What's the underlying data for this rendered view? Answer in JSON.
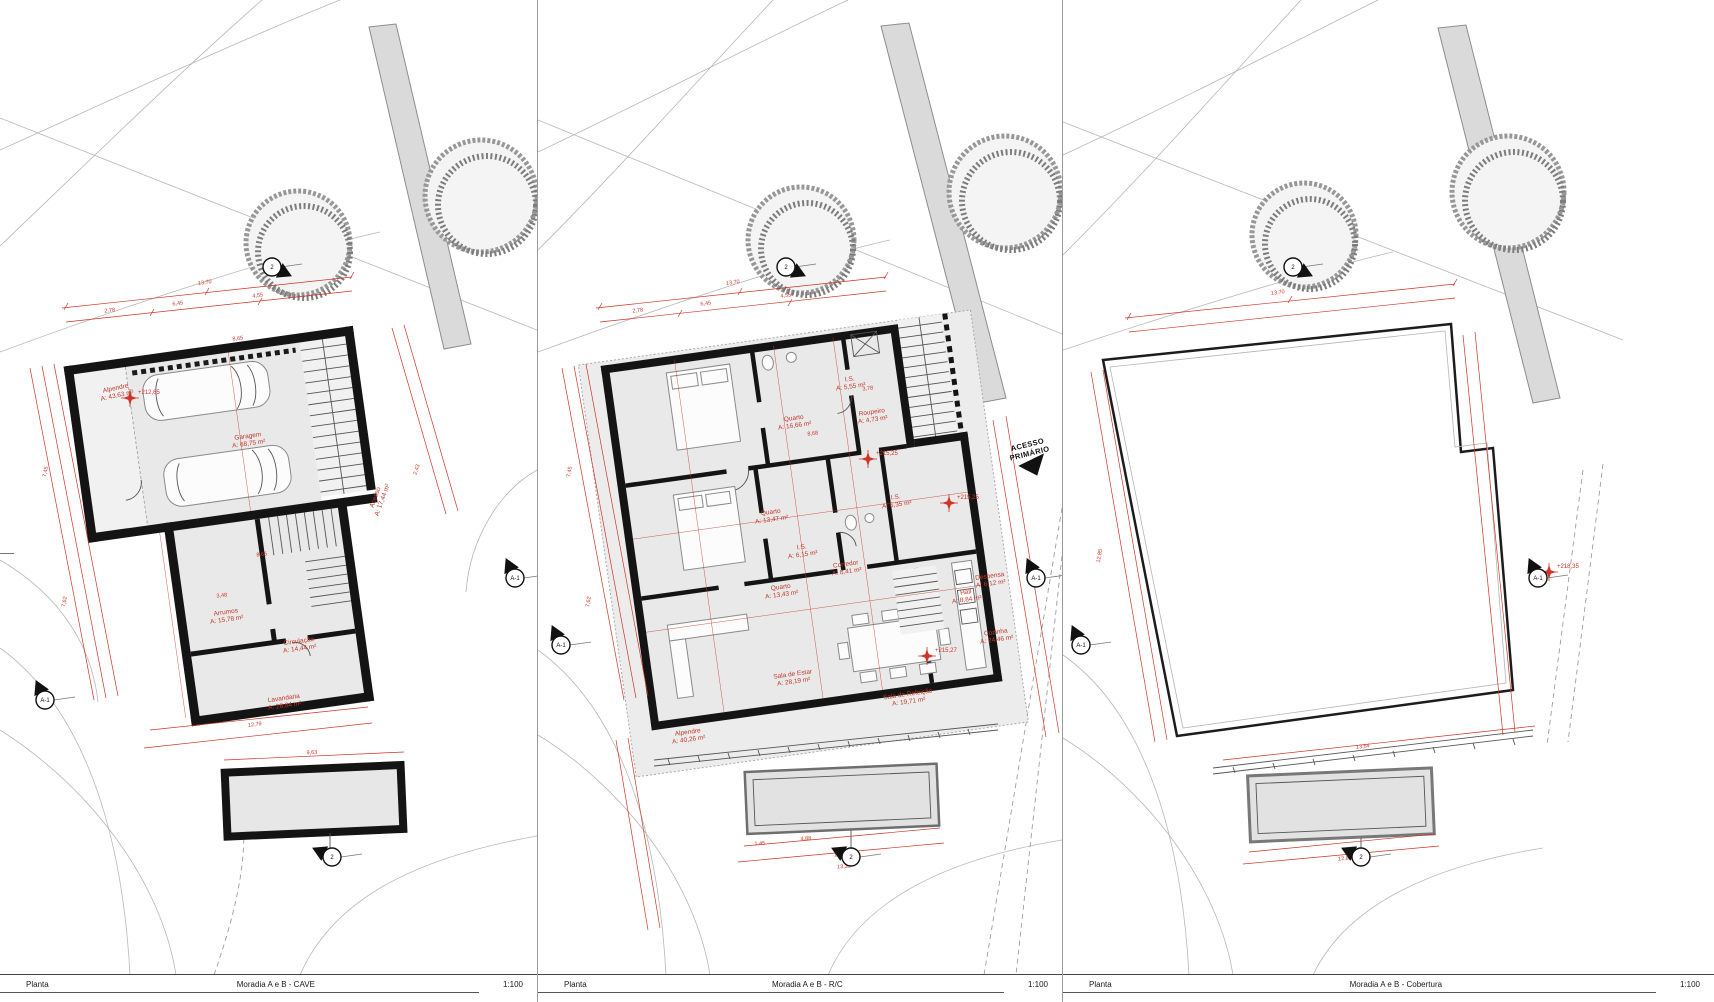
{
  "drawing": {
    "scale_note": "1:100",
    "colors": {
      "dimension_red": "#cf3428",
      "wall_black": "#141414",
      "floor_gray": "#e9e9e9"
    }
  },
  "sheets": [
    {
      "id": "cave",
      "footer": {
        "type": "Planta",
        "title": "Moradia A e B - CAVE",
        "scale": "1:100"
      },
      "rooms": [
        {
          "name": "Alpendre",
          "area": "A: 43,63 m²",
          "x": 116,
          "y": 390,
          "rot": -12
        },
        {
          "name": "Garagem",
          "area": "A: 68,75 m²",
          "x": 248,
          "y": 438,
          "rot": -8
        },
        {
          "name": "Acesso",
          "area": "A: 17,44 m²",
          "x": 377,
          "y": 498,
          "rot": -70
        },
        {
          "name": "Arrumos",
          "area": "A: 15,78 m²",
          "x": 226,
          "y": 614,
          "rot": -8
        },
        {
          "name": "Circulação",
          "area": "A: 14,44 m²",
          "x": 299,
          "y": 643,
          "rot": -8
        },
        {
          "name": "Lavandaria",
          "area": "A: 28,84 m²",
          "x": 284,
          "y": 700,
          "rot": -8
        }
      ],
      "levels": [
        {
          "text": "+212,65",
          "x": 130,
          "y": 398
        }
      ],
      "dims": [
        {
          "text": "13,70",
          "x": 205,
          "y": 284,
          "rot": -7
        },
        {
          "text": "2,78",
          "x": 110,
          "y": 312,
          "rot": -7
        },
        {
          "text": "6,45",
          "x": 178,
          "y": 305,
          "rot": -7
        },
        {
          "text": "4,55",
          "x": 258,
          "y": 297,
          "rot": -7
        },
        {
          "text": "8,65",
          "x": 238,
          "y": 340,
          "rot": -7
        },
        {
          "text": "3,48",
          "x": 222,
          "y": 597,
          "rot": -7
        },
        {
          "text": "8,65",
          "x": 262,
          "y": 556,
          "rot": -7
        },
        {
          "text": "7,45",
          "x": 47,
          "y": 472,
          "rot": -81
        },
        {
          "text": "7,62",
          "x": 66,
          "y": 602,
          "rot": -81
        },
        {
          "text": "12,79",
          "x": 255,
          "y": 726,
          "rot": -7
        },
        {
          "text": "9,63",
          "x": 312,
          "y": 754,
          "rot": -3
        },
        {
          "text": "2,43",
          "x": 418,
          "y": 470,
          "rot": -72
        }
      ],
      "markers": [
        {
          "label": "A-1",
          "x": 45,
          "y": 700,
          "rot": -25
        },
        {
          "label": "2",
          "x": 272,
          "y": 267,
          "rot": 115
        },
        {
          "label": "2",
          "x": 332,
          "y": 857,
          "rot": -65
        },
        {
          "label": "A-1",
          "x": 515,
          "y": 578,
          "rot": -25
        }
      ],
      "annotations": []
    },
    {
      "id": "rc",
      "footer": {
        "type": "Planta",
        "title": "Moradia A e B - R/C",
        "scale": "1:100"
      },
      "rooms": [
        {
          "name": "Quarto",
          "area": "A: 16,66 m²",
          "x": 256,
          "y": 420,
          "rot": -8
        },
        {
          "name": "I.S.",
          "area": "A: 5,55 m²",
          "x": 312,
          "y": 381,
          "rot": -8
        },
        {
          "name": "Roupeiro",
          "area": "A: 4,73 m²",
          "x": 334,
          "y": 414,
          "rot": -8
        },
        {
          "name": "Quarto",
          "area": "A: 13,47 m²",
          "x": 233,
          "y": 514,
          "rot": -8
        },
        {
          "name": "I.S.",
          "area": "A: 6,15 m²",
          "x": 264,
          "y": 549,
          "rot": -8
        },
        {
          "name": "Quarto",
          "area": "A: 13,43 m²",
          "x": 243,
          "y": 589,
          "rot": -8
        },
        {
          "name": "I.S.",
          "area": "A: 6,35 m²",
          "x": 358,
          "y": 499,
          "rot": -8
        },
        {
          "name": "Corredor",
          "area": "A: 8,41 m²",
          "x": 308,
          "y": 566,
          "rot": -8
        },
        {
          "name": "Despensa",
          "area": "A: 6,12 m²",
          "x": 452,
          "y": 578,
          "rot": -8
        },
        {
          "name": "Hall",
          "area": "A: 8,84 m²",
          "x": 428,
          "y": 594,
          "rot": -8
        },
        {
          "name": "Cozinha",
          "area": "A: 24,46 m²",
          "x": 458,
          "y": 634,
          "rot": -8
        },
        {
          "name": "Sala de Estar",
          "area": "A: 28,19 m²",
          "x": 255,
          "y": 676,
          "rot": -8
        },
        {
          "name": "Sala de Refeição",
          "area": "A: 19,71 m²",
          "x": 370,
          "y": 696,
          "rot": -8
        },
        {
          "name": "Alpendre",
          "area": "A: 40,26 m²",
          "x": 150,
          "y": 734,
          "rot": -8
        }
      ],
      "levels": [
        {
          "text": "+215,25",
          "x": 330,
          "y": 459
        },
        {
          "text": "+215,25",
          "x": 411,
          "y": 503
        },
        {
          "text": "+215,27",
          "x": 389,
          "y": 656
        }
      ],
      "dims": [
        {
          "text": "13,70",
          "x": 195,
          "y": 284,
          "rot": -7
        },
        {
          "text": "2,78",
          "x": 100,
          "y": 312,
          "rot": -7
        },
        {
          "text": "6,45",
          "x": 168,
          "y": 305,
          "rot": -7
        },
        {
          "text": "4,55",
          "x": 248,
          "y": 297,
          "rot": -7
        },
        {
          "text": "8,68",
          "x": 275,
          "y": 435,
          "rot": -7
        },
        {
          "text": "3,78",
          "x": 330,
          "y": 390,
          "rot": -7
        },
        {
          "text": "7,45",
          "x": 33,
          "y": 472,
          "rot": -81
        },
        {
          "text": "7,62",
          "x": 52,
          "y": 602,
          "rot": -81
        },
        {
          "text": "1,45",
          "x": 222,
          "y": 845,
          "rot": -4
        },
        {
          "text": "4,88",
          "x": 268,
          "y": 840,
          "rot": -4
        },
        {
          "text": "12,85",
          "x": 303,
          "y": 856,
          "rot": -4
        },
        {
          "text": "13,35",
          "x": 306,
          "y": 868,
          "rot": -4
        }
      ],
      "markers": [
        {
          "label": "A-1",
          "x": 23,
          "y": 645,
          "rot": -25
        },
        {
          "label": "2",
          "x": 248,
          "y": 267,
          "rot": 115
        },
        {
          "label": "2",
          "x": 313,
          "y": 857,
          "rot": -65
        },
        {
          "label": "A-1",
          "x": 498,
          "y": 578,
          "rot": -25
        }
      ],
      "annotations": [
        {
          "lines": [
            "ACESSO",
            "PRIMÁRIO"
          ],
          "x": 490,
          "y": 447,
          "rot": -14
        }
      ]
    },
    {
      "id": "cobertura",
      "footer": {
        "type": "Planta",
        "title": "Moradia A e B - Cobertura",
        "scale": "1:100"
      },
      "rooms": [],
      "levels": [
        {
          "text": "+218,35",
          "x": 486,
          "y": 572
        }
      ],
      "dims": [
        {
          "text": "13,70",
          "x": 215,
          "y": 294,
          "rot": -7
        },
        {
          "text": "12,85",
          "x": 38,
          "y": 556,
          "rot": -81
        },
        {
          "text": "13,64",
          "x": 300,
          "y": 748,
          "rot": -7
        },
        {
          "text": "12,85",
          "x": 282,
          "y": 860,
          "rot": -4
        }
      ],
      "markers": [
        {
          "label": "A-1",
          "x": 18,
          "y": 645,
          "rot": -25
        },
        {
          "label": "2",
          "x": 230,
          "y": 267,
          "rot": 115
        },
        {
          "label": "2",
          "x": 298,
          "y": 857,
          "rot": -65
        },
        {
          "label": "A-1",
          "x": 475,
          "y": 578,
          "rot": -25
        }
      ],
      "annotations": []
    }
  ]
}
